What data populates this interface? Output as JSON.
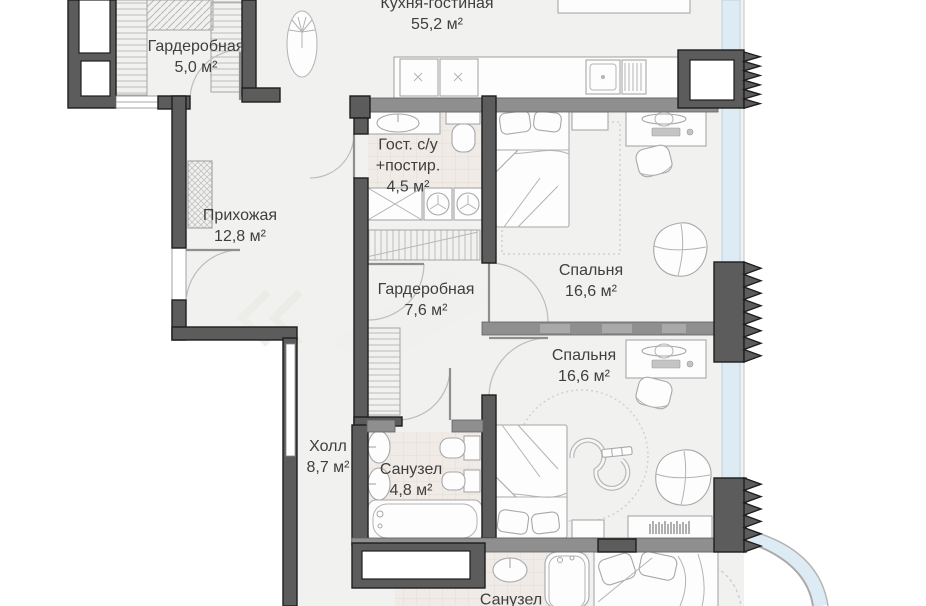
{
  "rooms": [
    {
      "id": "wardrobe-1",
      "lines": [
        "Гардеробная",
        "5,0 м²"
      ]
    },
    {
      "id": "kitchen-living",
      "lines": [
        "Кухня-гостиная",
        "55,2 м²"
      ]
    },
    {
      "id": "entry-hallway",
      "lines": [
        "Прихожая",
        "12,8 м²"
      ]
    },
    {
      "id": "guest-bathroom-laundry",
      "lines": [
        "Гост. с/у",
        "+постир.",
        "4,5 м²"
      ]
    },
    {
      "id": "wardrobe-2",
      "lines": [
        "Гардеробная",
        "7,6 м²"
      ]
    },
    {
      "id": "bedroom-1",
      "lines": [
        "Спальня",
        "16,6 м²"
      ]
    },
    {
      "id": "bedroom-2",
      "lines": [
        "Спальня",
        "16,6 м²"
      ]
    },
    {
      "id": "hall",
      "lines": [
        "Холл",
        "8,7 м²"
      ]
    },
    {
      "id": "bathroom-1",
      "lines": [
        "Санузел",
        "4,8 м²"
      ]
    },
    {
      "id": "bathroom-2",
      "lines": [
        "Санузел"
      ]
    }
  ],
  "colors": {
    "wall": "#5c5c5c",
    "wall_light": "#8f8f8f",
    "floor": "#f1f1f0",
    "glazing": "#dcebf4",
    "furniture_line": "#a8a8a8",
    "text": "#3f3f3f",
    "tile": "#f0ebe7"
  }
}
